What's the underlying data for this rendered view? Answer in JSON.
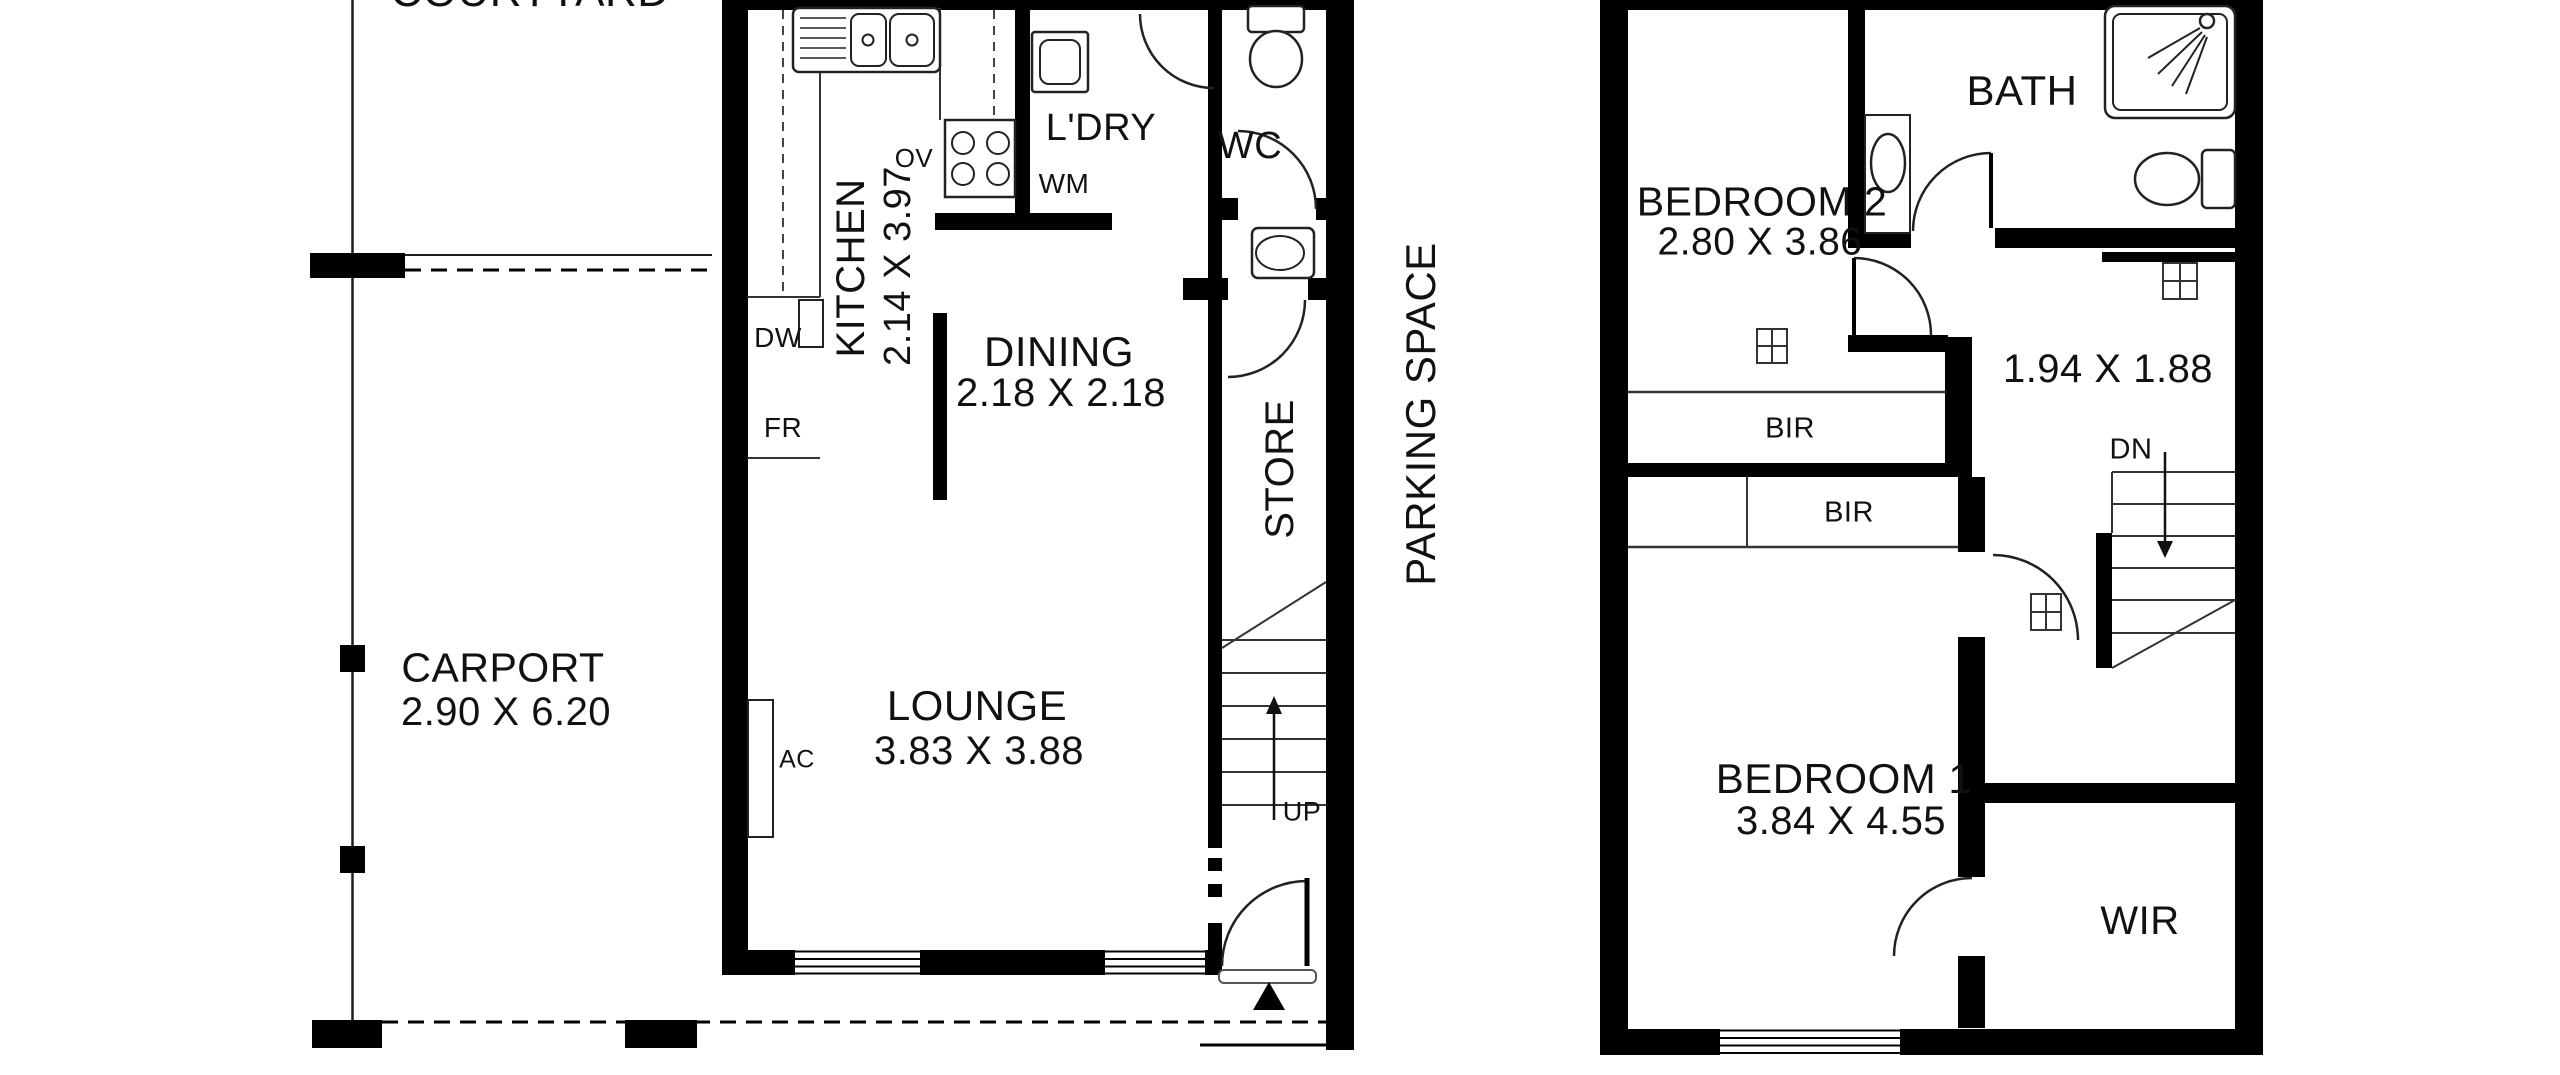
{
  "ground": {
    "courtyard": "COURTYARD",
    "carport": {
      "name": "CARPORT",
      "dims": "2.90 X 6.20"
    },
    "kitchen": {
      "name": "KITCHEN",
      "dims": "2.14 X 3.97"
    },
    "dining": {
      "name": "DINING",
      "dims": "2.18 X 2.18"
    },
    "lounge": {
      "name": "LOUNGE",
      "dims": "3.83 X 3.88"
    },
    "laundry": "L'DRY",
    "wc": "WC",
    "store": "STORE",
    "parking": "PARKING SPACE",
    "up": "UP",
    "appliances": {
      "ov": "OV",
      "wm": "WM",
      "dw": "DW",
      "fr": "FR",
      "ac": "AC"
    }
  },
  "upper": {
    "bath": "BATH",
    "bedroom2": {
      "name": "BEDROOM 2",
      "dims": "2.80 X 3.86"
    },
    "bedroom1": {
      "name": "BEDROOM 1",
      "dims": "3.84 X 4.55"
    },
    "hall_dims": "1.94 X 1.88",
    "bir_top": "BIR",
    "bir_bottom": "BIR",
    "wir": "WIR",
    "dn": "DN"
  },
  "colors": {
    "wall": "#000000",
    "line": "#1f1f1f",
    "text": "#111111",
    "background": "#ffffff"
  }
}
